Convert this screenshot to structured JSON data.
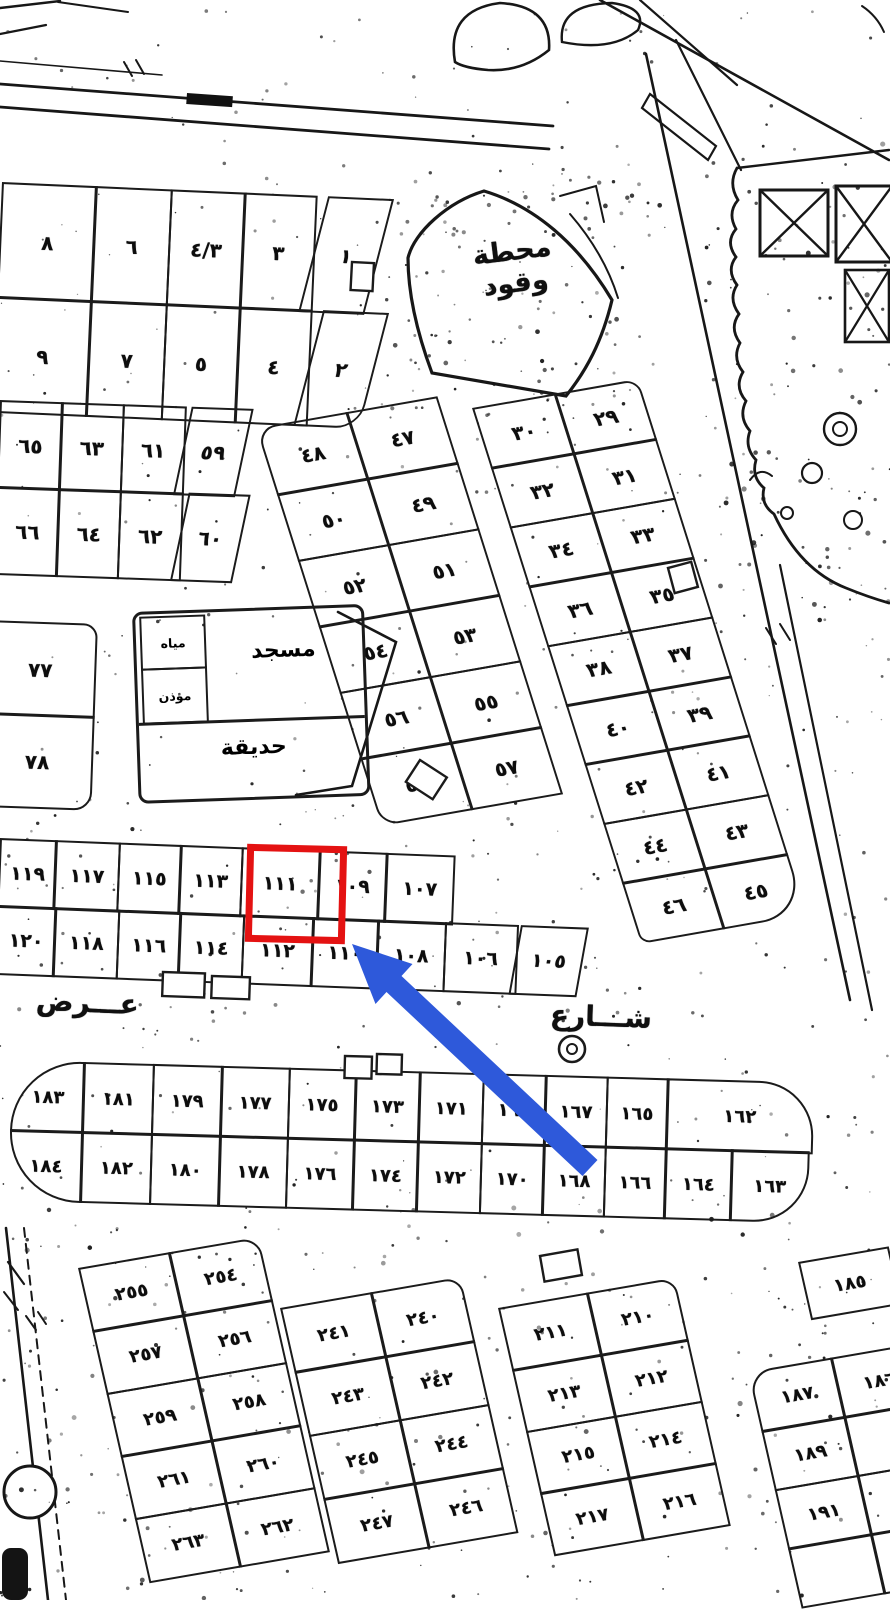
{
  "annotations": {
    "highlighted_plot": "١١١",
    "highlight_color": "#e41212",
    "arrow_color": "#2e59da"
  },
  "street_labels": {
    "left": "عـــرض",
    "right": "شـــارع"
  },
  "landmarks": {
    "fuel_station_line1": "محطة",
    "fuel_station_line2": "وقود",
    "mosque": "مسجد",
    "garden": "حديقة",
    "utility_top": "مياه",
    "utility_bottom": "مؤذن"
  },
  "blocks": {
    "block_1_9": [
      [
        "٨",
        "٦",
        "٤/٣",
        "٣",
        "١"
      ],
      [
        "٩",
        "٧",
        "٥",
        "٤",
        "٢"
      ]
    ],
    "block_59_66": [
      [
        "٦٥",
        "٦٣",
        "٦١",
        "٥٩"
      ],
      [
        "٦٦",
        "٦٤",
        "٦٢",
        "٦٠"
      ]
    ],
    "block_77_78": [
      [
        "٧٧"
      ],
      [
        "٧٨"
      ]
    ],
    "block_47_58": [
      [
        "٤٨",
        "٤٧"
      ],
      [
        "٥٠",
        "٤٩"
      ],
      [
        "٥٢",
        "٥١"
      ],
      [
        "٥٤",
        "٥٣"
      ],
      [
        "٥٦",
        "٥٥"
      ],
      [
        "٥٨",
        "٥٧"
      ]
    ],
    "block_29_46": [
      [
        "٣٠",
        "٢٩"
      ],
      [
        "٣٢",
        "٣١"
      ],
      [
        "٣٤",
        "٣٣"
      ],
      [
        "٣٦",
        "٣٥"
      ],
      [
        "٣٨",
        "٣٧"
      ],
      [
        "٤٠",
        "٣٩"
      ],
      [
        "٤٢",
        "٤١"
      ],
      [
        "٤٤",
        "٤٣"
      ],
      [
        "٤٦",
        "٤٥"
      ]
    ],
    "block_105_120": [
      [
        "١١٩",
        "١١٧",
        "١١٥",
        "١١٣",
        "١١١",
        "١٠٩",
        "١٠٧"
      ],
      [
        "١٢٠",
        "١١٨",
        "١١٦",
        "١١٤",
        "١١٢",
        "١١٠",
        "١٠٨",
        "١٠٦",
        "١٠٥"
      ]
    ],
    "block_163_184": [
      [
        "١٨٣",
        "١٨١",
        "١٧٩",
        "١٧٧",
        "١٧٥",
        "١٧٣",
        "١٧١",
        "١٦٩",
        "١٦٧",
        "١٦٥",
        "١٦٢"
      ],
      [
        "١٨٤",
        "١٨٢",
        "١٨٠",
        "١٧٨",
        "١٧٦",
        "١٧٤",
        "١٧٢",
        "١٧٠",
        "١٦٨",
        "١٦٦",
        "١٦٤",
        "١٦٣"
      ]
    ],
    "block_254_263": [
      [
        "٢٥٥",
        "٢٥٤"
      ],
      [
        "٢٥٧",
        "٢٥٦"
      ],
      [
        "٢٥٩",
        "٢٥٨"
      ],
      [
        "٢٦١",
        "٢٦٠"
      ],
      [
        "٢٦٣",
        "٢٦٢"
      ]
    ],
    "block_240_247": [
      [
        "٢٤١",
        "٢٤٠"
      ],
      [
        "٢٤٣",
        "٢٤٢"
      ],
      [
        "٢٤٥",
        "٢٤٤"
      ],
      [
        "٢٤٧",
        "٢٤٦"
      ]
    ],
    "block_210_217": [
      [
        "٢١١",
        "٢١٠"
      ],
      [
        "٢١٣",
        "٢١٢"
      ],
      [
        "٢١٥",
        "٢١٤"
      ],
      [
        "٢١٧",
        "٢١٦"
      ]
    ],
    "block_185": [
      [
        "١٨٥"
      ]
    ],
    "block_186_191": [
      [
        "١٨٧",
        "١٨٦"
      ],
      [
        "١٨٩",
        ""
      ],
      [
        "١٩١",
        ""
      ],
      [
        "",
        ""
      ]
    ]
  }
}
